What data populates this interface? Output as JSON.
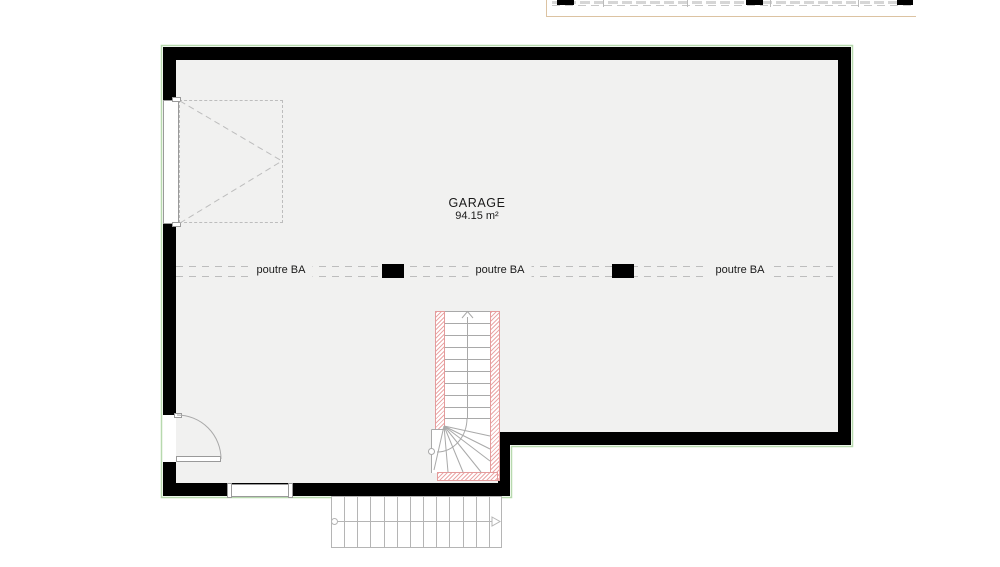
{
  "plan": {
    "room": {
      "name": "GARAGE",
      "area": "94.15 m²"
    },
    "beams": {
      "label_1": "poutre BA",
      "label_2": "poutre BA",
      "label_3": "poutre BA"
    }
  },
  "colors": {
    "wall": "#000000",
    "interior_floor": "#f1f1f0",
    "perimeter_outline": "#b7d9ae",
    "beam_dash": "#bdbdbd",
    "stair_line": "#a9a9a9",
    "insulation_hatch": "#db6060",
    "section_line_tan": "#dcc3a2",
    "text": "#1a1a1a"
  }
}
